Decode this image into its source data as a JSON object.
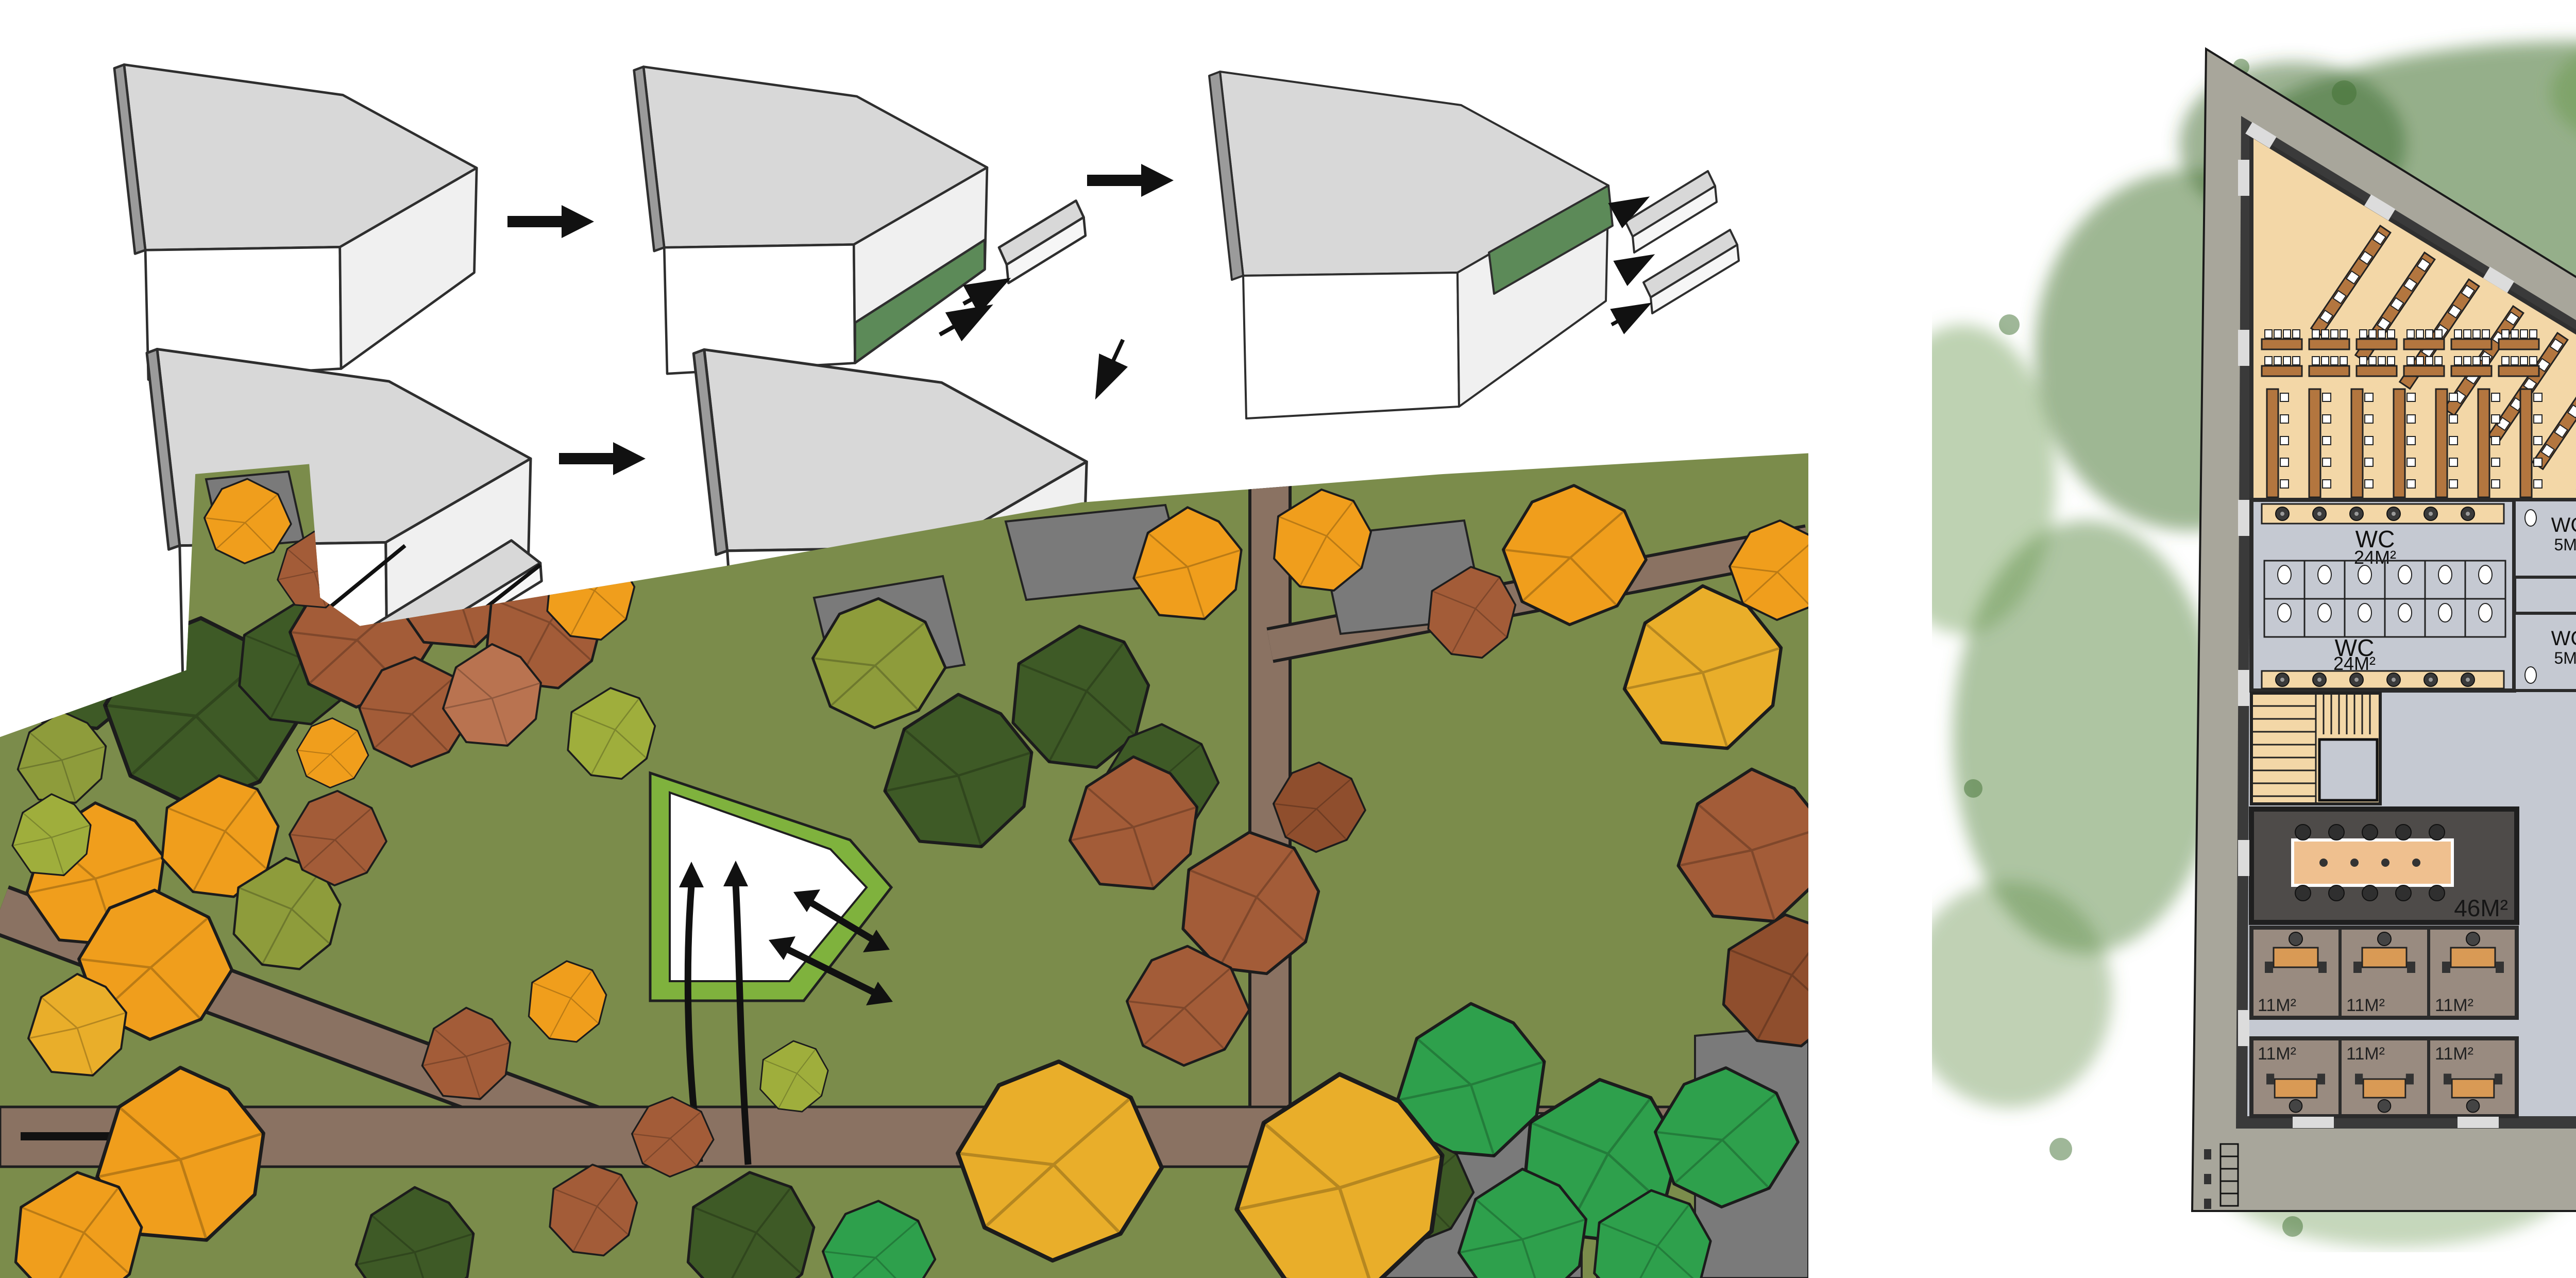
{
  "legend": {
    "items": [
      {
        "label": "Workshop",
        "color": "#A4674B"
      },
      {
        "label": "Lecture Hall",
        "color": "#F2D8AC"
      },
      {
        "label": "Meeting room",
        "color": "#575452"
      },
      {
        "label": "Teachers' room",
        "color": "#93897F"
      }
    ]
  },
  "floor_plan": {
    "lecture_hall": {
      "label": "Lecture Hall",
      "area": "156M²"
    },
    "workshop_a": {
      "label": "Workshop",
      "area": "82M²"
    },
    "workshop_b": {
      "label": "Workshop",
      "area": "131M²"
    },
    "canteen": {
      "label": "Canteen"
    },
    "exhibition": {
      "label": "Exhibition Space",
      "area": "250M²"
    },
    "meeting_room": {
      "area": "46M²"
    },
    "wc": {
      "label": "WC",
      "large_area": "24M²",
      "small_area": "5M²"
    },
    "office": {
      "area": "11M²"
    },
    "title": {
      "line1": "Ground Floor Plan",
      "line2": "1/50"
    }
  },
  "colors": {
    "diagram_green": "#5C8A58",
    "site_ground": "#7B8C4B",
    "site_path": "#8A7262",
    "footprint_border": "#7FB23D",
    "walkway": "#A8A69B",
    "walls": "#3A3A3A",
    "floor": "#C5C9D2",
    "lecture_floor": "#F3D7A7",
    "workshop_floor": "#A4674B",
    "meeting_floor": "#4E4B49",
    "office_floor": "#998B80",
    "bench": "#B3763F",
    "canteen_table": "#477E8C",
    "tree_palette": [
      "#3E5A26",
      "#5E7A2E",
      "#2EA04C",
      "#9FAE3C",
      "#8E9C3B",
      "#F09E1C",
      "#E9AE2A",
      "#A35C38",
      "#8F4E2D",
      "#B97350"
    ]
  }
}
